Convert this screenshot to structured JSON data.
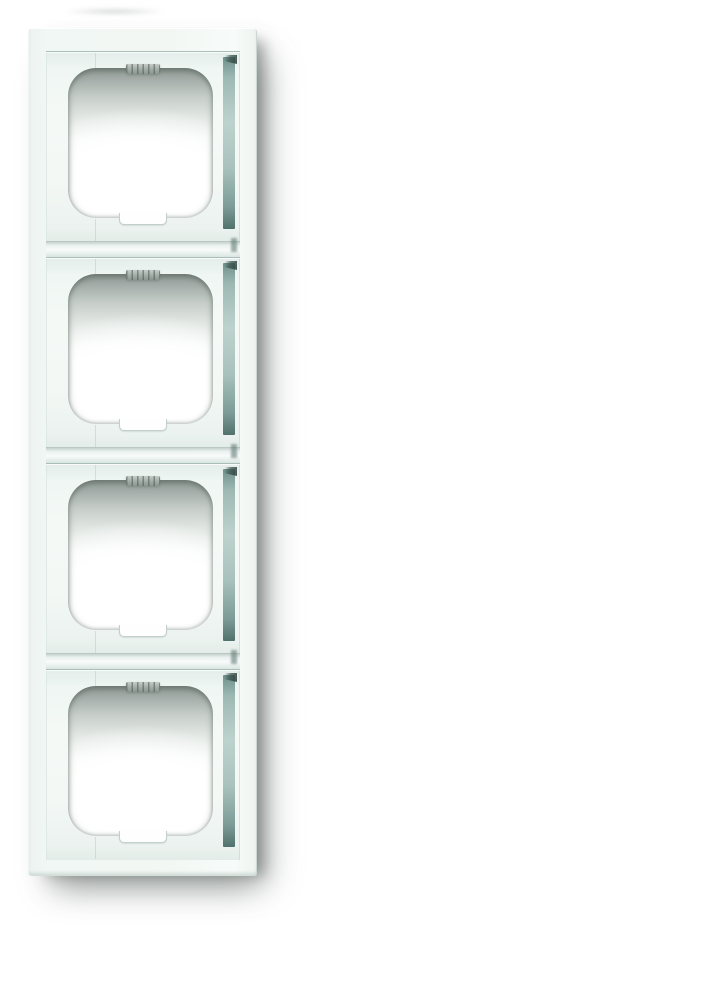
{
  "meta": {
    "alt": "Product photo of a white vertical four-gang switch cover frame on a white background",
    "scene": "studio product photograph, soft drop shadow to the lower right"
  },
  "product": {
    "type": "electrical cover frame",
    "gang_count": 4,
    "orientation": "vertical",
    "finish": "glossy white",
    "parts_per_gang": [
      "raised plateau",
      "rounded-square opening",
      "serrated fixing-clip tab",
      "bottom notch",
      "right shade band"
    ],
    "divider_grooves": 3
  },
  "colors": {
    "background": "#ffffff",
    "frame_surface": "#f1f7f4",
    "plateau_surface": "#f4f9f6",
    "plateau_edge_line": "#a9beb8",
    "opening_shadow_dark": "#8d9792",
    "teal_band_light": "#bdd2cd",
    "teal_band_mid": "#9db8b3",
    "teal_band_dark": "#51716c",
    "tab_gray": "#a2aca7",
    "notch_outline": "#c3cfca",
    "drop_shadow": "#6e7471"
  }
}
